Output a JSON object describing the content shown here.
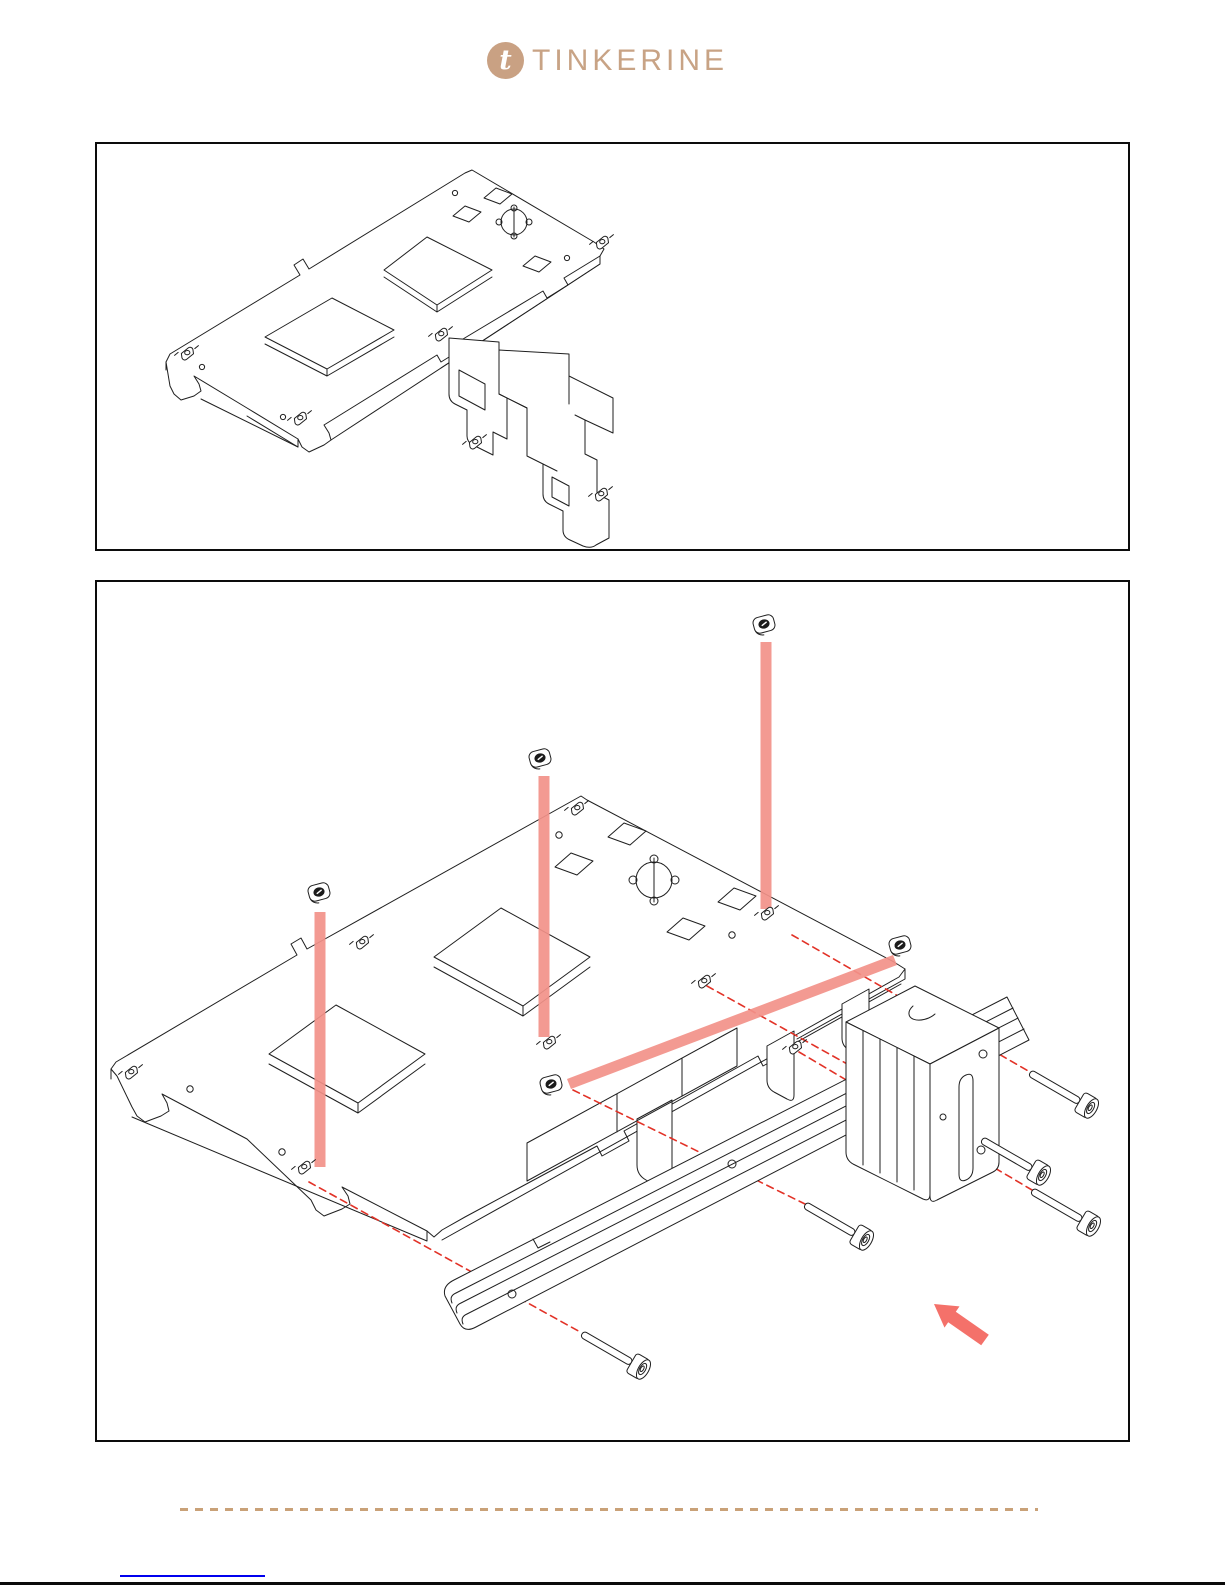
{
  "page": {
    "background": "#ffffff",
    "bottom_edge_color": "#0a0a0a"
  },
  "header": {
    "logo_text": "TINKERINE",
    "logo_glyph": "t",
    "brand_color": "#c8a385",
    "logo_circle_color": "#c9a183"
  },
  "figures": {
    "top": {
      "name": "gantry-plate-with-bracket-drawing",
      "border_color": "#0c0c0c",
      "line_color": "#1f1f1f"
    },
    "bottom": {
      "name": "exploded-assembly-drawing",
      "border_color": "#0c0c0c",
      "line_color": "#1f1f1f",
      "square_nuts": 5,
      "screws": 5,
      "highlight_bars": 4,
      "highlight_color": "#f29189",
      "guide_dash_color": "#e23227",
      "arrow_color": "#f4716a",
      "arrow_direction": "up-left"
    }
  },
  "divider": {
    "color": "#c9a178",
    "style": "dashed"
  },
  "footer": {
    "link_underline_color": "#0000ee"
  }
}
